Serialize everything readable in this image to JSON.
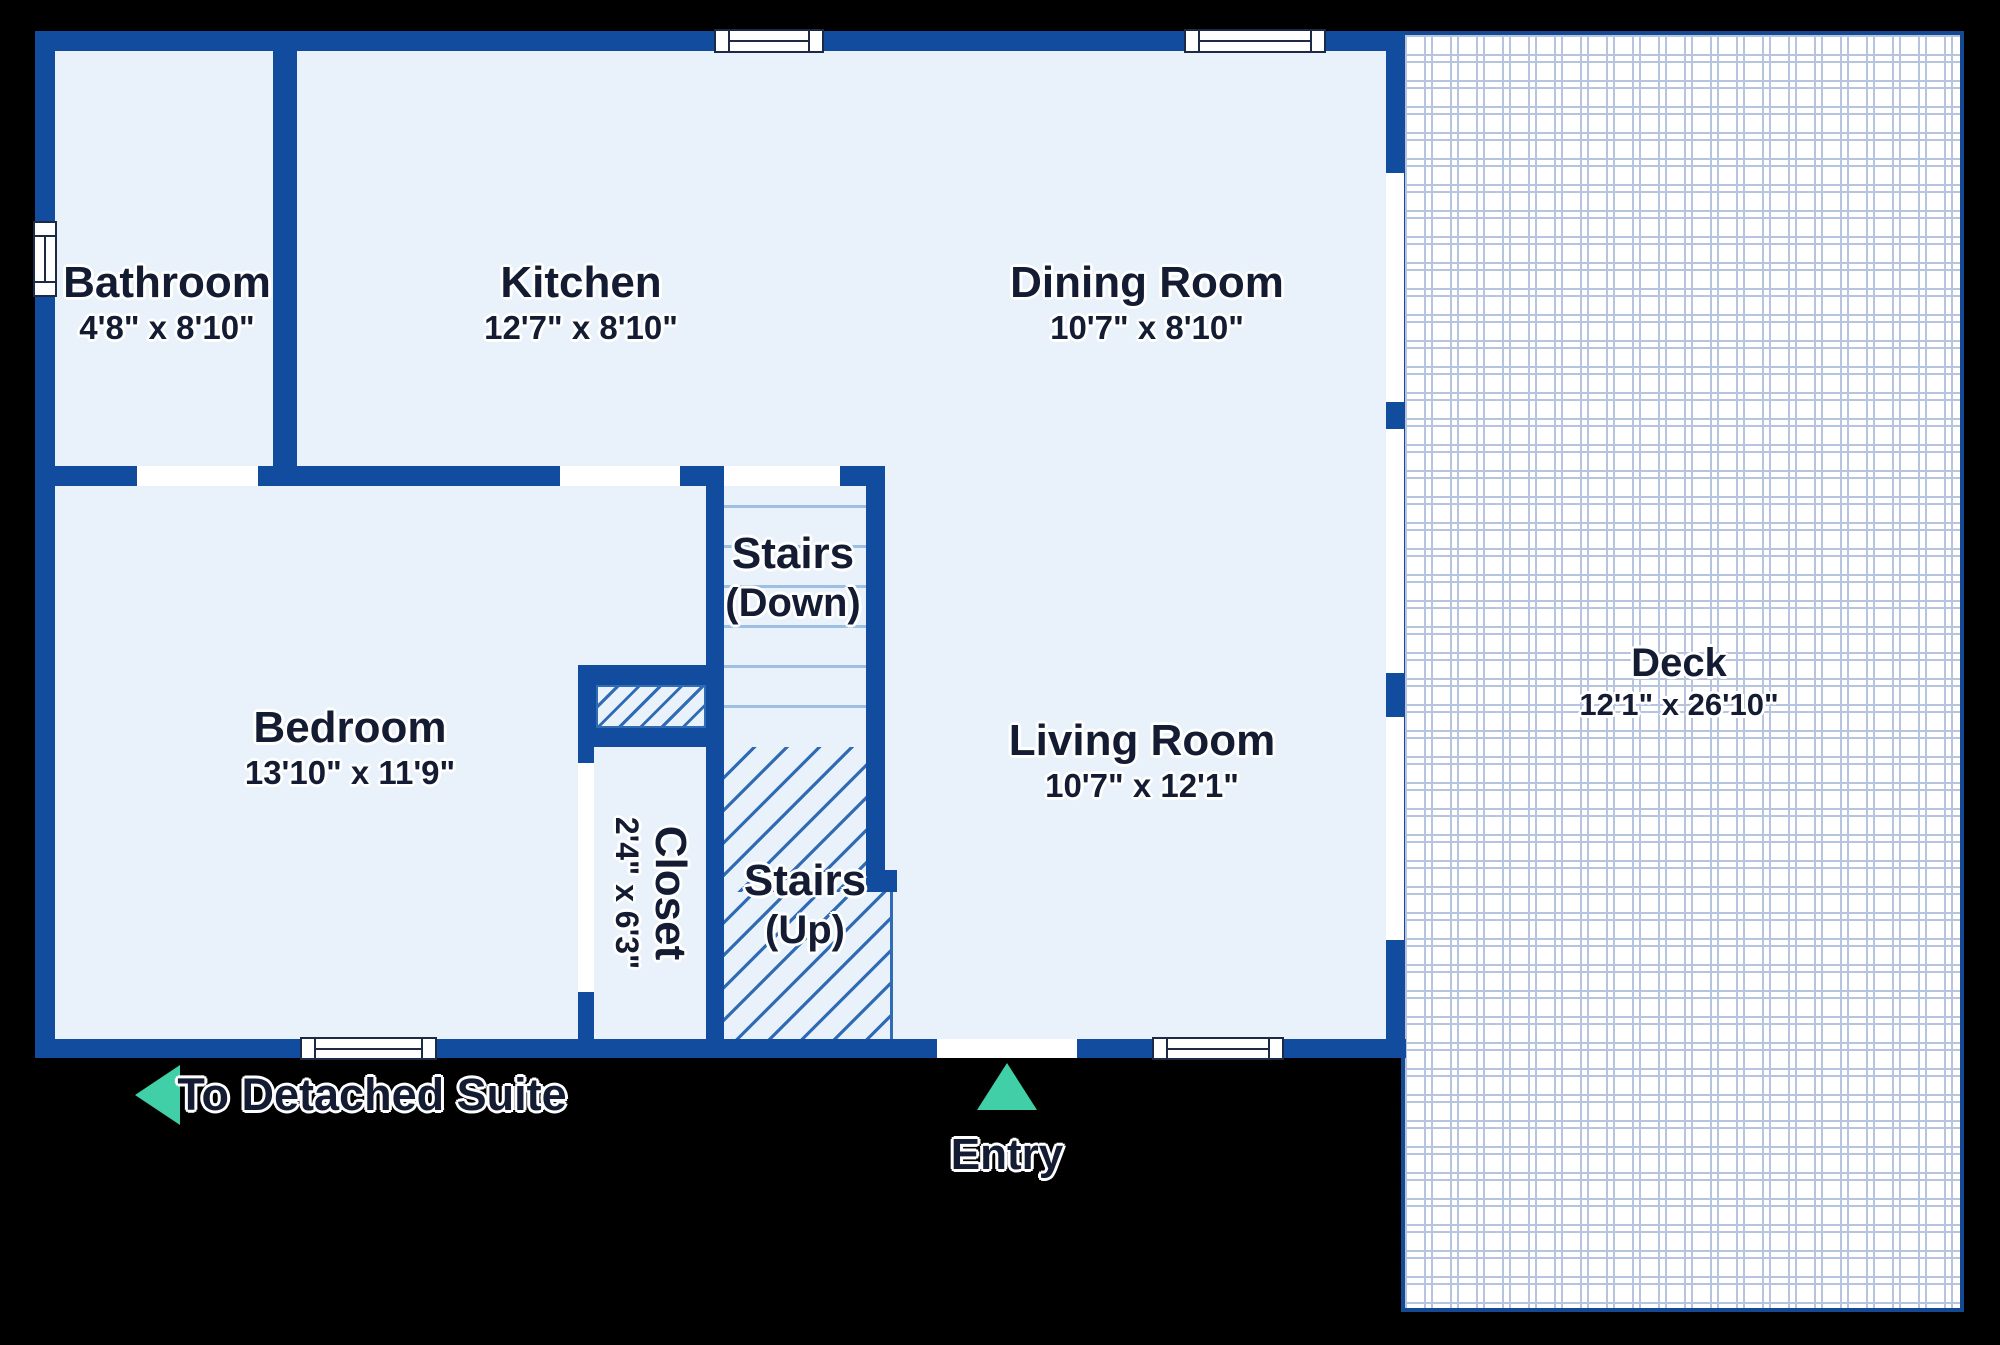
{
  "colors": {
    "wall": "#114c9f",
    "floor": "#e9f1fb",
    "tread": "#9cbfe3",
    "hatch": "#2f6cb5",
    "deck-line": "#b6c4df",
    "deck-border": "#134a93",
    "text": "#141c33",
    "teal": "#41cfa8",
    "frame": "#1c2a45",
    "white": "#ffffff"
  },
  "rooms": {
    "bathroom": {
      "name": "Bathroom",
      "dims": "4'8\" x 8'10\""
    },
    "kitchen": {
      "name": "Kitchen",
      "dims": "12'7\" x 8'10\""
    },
    "dining_room": {
      "name": "Dining Room",
      "dims": "10'7\" x 8'10\""
    },
    "stairs_down": {
      "name": "Stairs",
      "dims": "(Down)"
    },
    "bedroom": {
      "name": "Bedroom",
      "dims": "13'10\" x 11'9\""
    },
    "closet": {
      "name": "Closet",
      "dims": "2'4\" x 6'3\""
    },
    "stairs_up": {
      "name": "Stairs",
      "dims": "(Up)"
    },
    "living_room": {
      "name": "Living Room",
      "dims": "10'7\" x 12'1\""
    },
    "deck": {
      "name": "Deck",
      "dims": "12'1\" x 26'10\""
    }
  },
  "annotations": {
    "to_detached_suite": {
      "label": "To Detached Suite",
      "arrow": "left"
    },
    "entry": {
      "label": "Entry",
      "arrow": "up"
    }
  }
}
